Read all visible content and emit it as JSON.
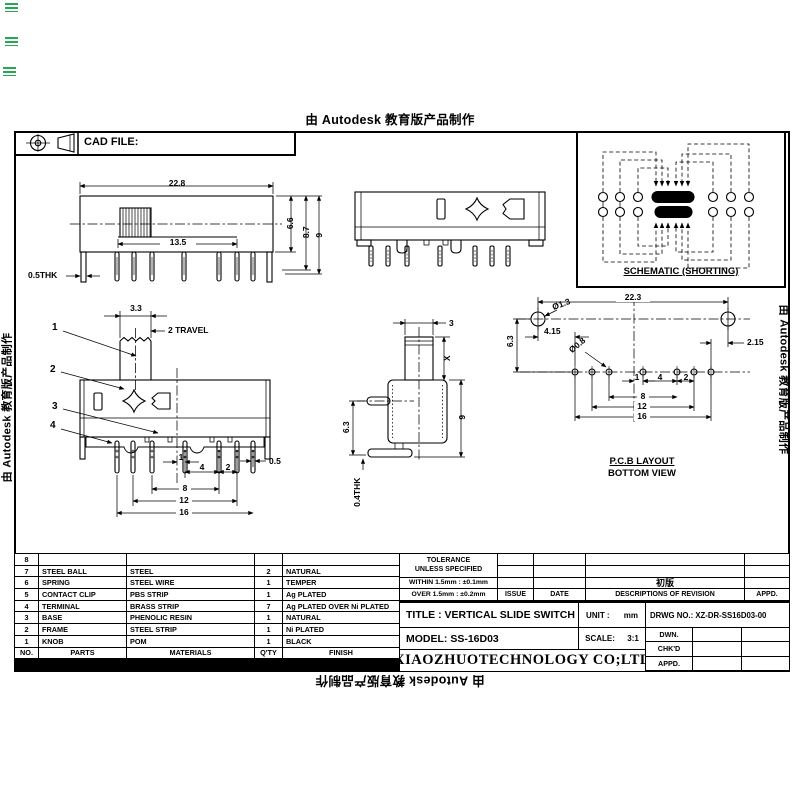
{
  "colors": {
    "ink": "#000000",
    "paper": "#ffffff",
    "mark_green": "#1fa24a"
  },
  "watermarks": {
    "top": "由 Autodesk 教育版产品制作",
    "left": "由 Autodesk 教育版产品制作",
    "right": "由 Autodesk 教育版产品制作",
    "bottom": "由 Autodesk 教育版产品制作"
  },
  "header": {
    "cad_file_label": "CAD FILE:"
  },
  "schematic": {
    "label": "SCHEMATIC (SHORTING)"
  },
  "front_view": {
    "width": "22.8",
    "travel_span": "13.5",
    "body_height": "6.6",
    "shoulder_height": "8.7",
    "total_height": "9",
    "thickness": "0.5THK"
  },
  "detail_view": {
    "knob_width": "3.3",
    "travel": "2 TRAVEL",
    "callout_1": "1",
    "callout_2": "2",
    "callout_3": "3",
    "callout_4": "4",
    "pitch_1": "1",
    "pitch_4": "4",
    "pitch_2": "2",
    "pin_width": "0.5",
    "span_8": "8",
    "span_12": "12",
    "span_16": "16"
  },
  "side_view": {
    "knob_width": "3",
    "knob_height": "X",
    "total_height": "9",
    "pin_offset": "6.3",
    "thickness": "0.4THK"
  },
  "pcb_view": {
    "title": "P.C.B LAYOUT",
    "subtitle": "BOTTOM VIEW",
    "width": "22.3",
    "hole_large": "Ø1.3",
    "offset_left": "4.15",
    "row_gap": "6.3",
    "offset_right": "2.15",
    "hole_small": "Ø0.8",
    "pitch_1": "1",
    "pitch_4": "4",
    "pitch_2": "2",
    "span_8": "8",
    "span_12": "12",
    "span_16": "16"
  },
  "parts_table": {
    "headers": {
      "no": "NO.",
      "parts": "PARTS",
      "materials": "MATERIALS",
      "qty": "Q'TY",
      "finish": "FINISH"
    },
    "rows": [
      {
        "no": "8",
        "parts": "",
        "materials": "",
        "qty": "",
        "finish": ""
      },
      {
        "no": "7",
        "parts": "STEEL BALL",
        "materials": "STEEL",
        "qty": "2",
        "finish": "NATURAL"
      },
      {
        "no": "6",
        "parts": "SPRING",
        "materials": "STEEL WIRE",
        "qty": "1",
        "finish": "TEMPER"
      },
      {
        "no": "5",
        "parts": "CONTACT CLIP",
        "materials": "PBS STRIP",
        "qty": "1",
        "finish": "Ag PLATED"
      },
      {
        "no": "4",
        "parts": "TERMINAL",
        "materials": "BRASS STRIP",
        "qty": "7",
        "finish": "Ag PLATED OVER Ni PLATED"
      },
      {
        "no": "3",
        "parts": "BASE",
        "materials": "PHENOLIC RESIN",
        "qty": "1",
        "finish": "NATURAL"
      },
      {
        "no": "2",
        "parts": "FRAME",
        "materials": "STEEL STRIP",
        "qty": "1",
        "finish": "Ni PLATED"
      },
      {
        "no": "1",
        "parts": "KNOB",
        "materials": "POM",
        "qty": "1",
        "finish": "BLACK"
      }
    ]
  },
  "tolerance_block": {
    "title": "TOLERANCE",
    "subtitle": "UNLESS  SPECIFIED",
    "within": "WITHIN 1.5mm : ±0.1mm",
    "over": "OVER 1.5mm :  ±0.2mm"
  },
  "revision_block": {
    "entry": "初版",
    "issue": "ISSUE",
    "date": "DATE",
    "descriptions": "DESCRIPTIONS OF REVISION",
    "appd": "APPD."
  },
  "title_block": {
    "title": "TITLE : VERTICAL SLIDE SWITCH",
    "model": "MODEL: SS-16D03",
    "company": "XIAOZHUOTECHNOLOGY  CO;LTD",
    "unit_label": "UNIT :",
    "unit_value": "mm",
    "scale_label": "SCALE:",
    "scale_value": "3:1",
    "drwg_no": "DRWG NO.: XZ-DR-SS16D03-00",
    "dwn": "DWN.",
    "chkd": "CHK'D",
    "appd": "APPD."
  }
}
